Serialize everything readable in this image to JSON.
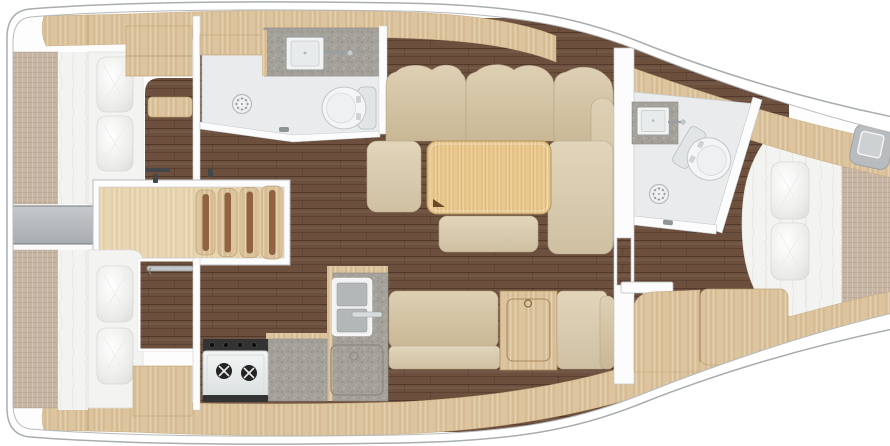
{
  "scene": {
    "title": "Sailboat interior floor plan (top-down)",
    "type": "yacht layout diagram",
    "orientation": {
      "bow": "right",
      "stern": "left"
    }
  },
  "rooms": [
    {
      "label": "Aft cabin port",
      "features": [
        "double berth",
        "two pillows",
        "locker cabinet",
        "wood step"
      ]
    },
    {
      "label": "Aft head",
      "features": [
        "washbasin",
        "marine toilet",
        "shower drain",
        "countertop"
      ]
    },
    {
      "label": "Companionway",
      "features": [
        "four wooden steps",
        "hatch fittings"
      ]
    },
    {
      "label": "Aft cabin starboard",
      "features": [
        "double berth",
        "two pillows",
        "hanging locker with rail",
        "lockers"
      ]
    },
    {
      "label": "Galley",
      "features": [
        "two-burner stove",
        "double sink",
        "top-loading fridge",
        "worktop"
      ]
    },
    {
      "label": "Saloon",
      "features": [
        "L-shaped settee",
        "folding table",
        "stool",
        "bench",
        "settee with locker cabinet"
      ]
    },
    {
      "label": "Forward head",
      "features": [
        "washbasin",
        "marine toilet",
        "shower drain"
      ]
    },
    {
      "label": "Forward cabin",
      "features": [
        "V-berth",
        "two pillows",
        "wood seat",
        "deck hatch"
      ]
    }
  ],
  "colors": {
    "hull-line": "#a8adb0",
    "deck-line": "#b6babd",
    "wood": "#dcc49e",
    "wood-grain": "#c49f6b",
    "wood-light": "#e7d6b1",
    "table-wood": "#e8c88f",
    "floor-dark": "#6d4f3d",
    "floor-seam": "#52392a",
    "weave": "#c7b5a4",
    "sofa-hi": "#ded0b4",
    "sofa-lo": "#c9b795",
    "seat-hi": "#e1d5bb",
    "seat-lo": "#cfc0a2",
    "speckle": "#a4a09a",
    "bath-floor": "#e9ebec",
    "walkway": "#b7babc",
    "soft-white": "#f3f3f1",
    "wardrobe": "#5f4534"
  }
}
